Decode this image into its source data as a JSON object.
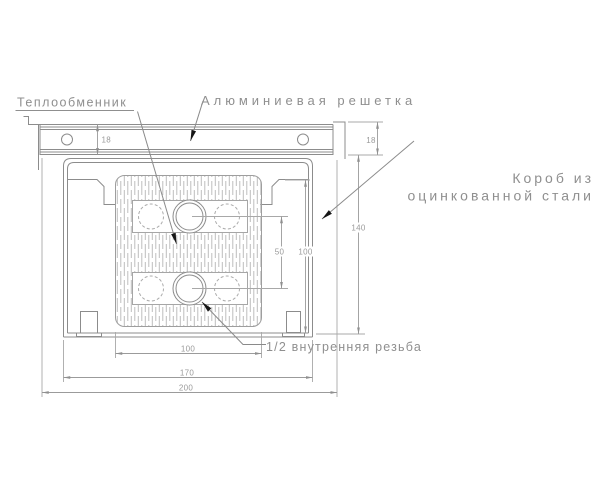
{
  "drawing": {
    "title_hint": "convector cross-section drawing",
    "labels": {
      "heat_exchanger": "Теплообменник",
      "grille": "Алюминиевая решетка",
      "box_line1": "Короб из",
      "box_line2": "оцинкованной стали",
      "thread": "1/2 внутренняя резьба"
    },
    "dimensions": {
      "grille_height_left": "18",
      "grille_height_right": "18",
      "box_height": "140",
      "inner_height": "100",
      "pipe_spacing": "50",
      "core_width": "100",
      "box_width": "170",
      "overall_width": "200"
    },
    "colors": {
      "line": "#8c8c8c",
      "dim_line": "#a3a3a3",
      "text": "#8a8a8a",
      "dim_text": "#9a9a9a",
      "leader_arrow": "#1a1a1a",
      "hatch": "#bdbdbd",
      "background": "#ffffff"
    }
  }
}
